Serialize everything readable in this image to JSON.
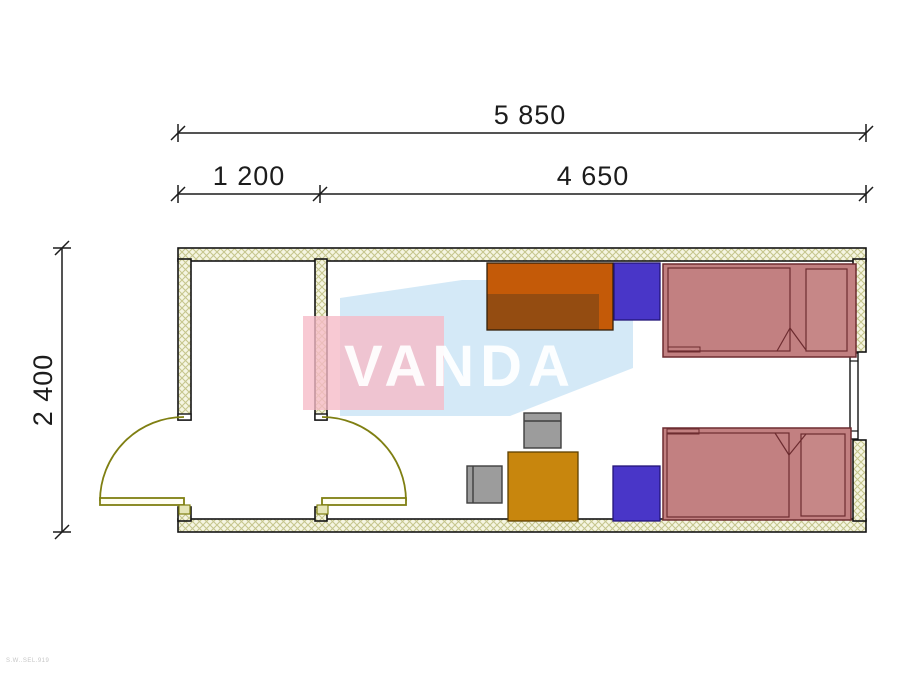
{
  "drawing": {
    "type": "floor-plan",
    "dimensions": {
      "overall_width": "5 850",
      "entry_width": "1 200",
      "main_room_width": "4 650",
      "overall_depth": "2 400"
    },
    "watermark": "VANDA",
    "corner_note": "S.W..SEL.919",
    "colors": {
      "wall_fill": "#f5f5e2",
      "wall_hatch": "#c6c68e",
      "outline": "#141414",
      "door": "#7f7f12",
      "bed": "#c28081",
      "bed_outline": "#6d2c30",
      "cabinet": "#4936c8",
      "cabinet_outline": "#231578",
      "desk": "#c45a08",
      "desk_shadow": "#8d4a12",
      "table": "#c8860d",
      "chair": "#9c9c9c",
      "watermark_pink": "#f6bac6",
      "watermark_blue": "#badbf2"
    },
    "elements": [
      "exterior-door",
      "interior-door",
      "window",
      "desk",
      "cabinet-top",
      "cabinet-bottom",
      "bed-top",
      "bed-bottom",
      "table",
      "chair-top",
      "chair-left"
    ]
  }
}
